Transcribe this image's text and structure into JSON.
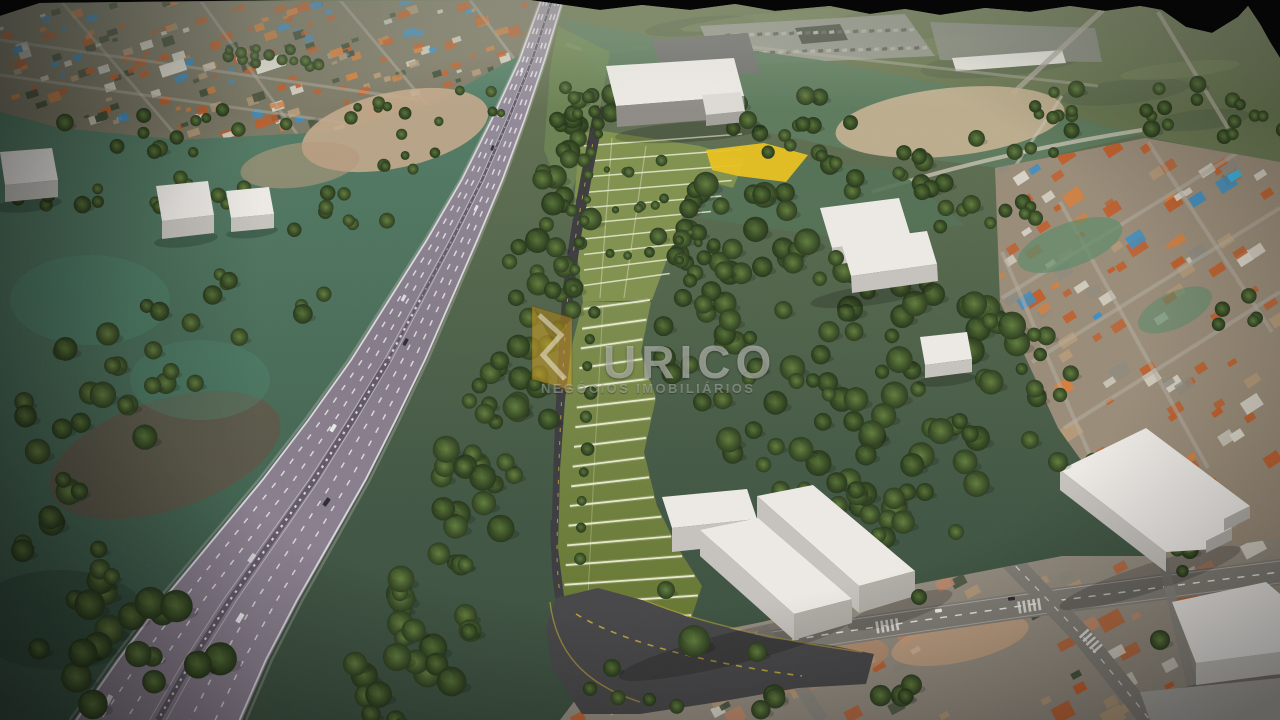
{
  "watermark": {
    "brand": "URICO",
    "tagline": "NEGÓCIOS IMOBILIÁRIOS"
  },
  "palette": {
    "sky": "#060606",
    "base_top": "#6d7657",
    "base_mid": "#55684d",
    "base_bot": "#415744",
    "far_field": "#6a7852",
    "urban_base": "#7d7a67",
    "city_right_base": "#9a8c79",
    "city_bottom_base": "#948c80",
    "roof_orange": "#c05f2c",
    "roof_orange2": "#d4803f",
    "roof_white": "#d9d5c9",
    "roof_dark": "#44503a",
    "roof_blue": "#3e8fc4",
    "roof_tan": "#b59a78",
    "roof_gray": "#8f8b80",
    "roof_salmon": "#c08a6a",
    "street_light": "#b3ada0",
    "asphalt_city": "#827e77",
    "teal_top": "#567f68",
    "teal_bot": "#3a5747",
    "dirt": "#c3a98b",
    "dirt_warm": "#c7b294",
    "salmon": "#c08a6a",
    "redbrown": "#6e4c42",
    "highway_top": "#9a93a1",
    "highway_mid": "#857b89",
    "highway_bot": "#8d8292",
    "median": "#5e5564",
    "lane_white": "#efedf1",
    "lawn_upper": "#81924f",
    "lot_top": "#7c8d4e",
    "lot_bot": "#64742f",
    "lot_line": "#eff1d8",
    "lot_yellow": "#e9c121",
    "road_dark": "#3d3d41",
    "road_access": "#474749",
    "road_yellow": "#d7b83c",
    "tree_hi": "#617e3e",
    "tree_mid": "#44592c",
    "tree_dark": "#2c3e20",
    "tree_hi2": "#546f36",
    "tree_mid2": "#3b5026",
    "tree_dark2": "#26371c",
    "bldg_roof": "#edeae6",
    "bldg_side": "#c6c3be",
    "bldg_end": "#b2afa9",
    "bldg_face": "#8f8c87",
    "pool_blue": "#3fb0d8",
    "wm_text": "rgba(216,218,214,0.55)",
    "wm_text_dim": "rgba(205,207,203,0.42)",
    "wm_gold": "rgba(203,158,40,0.58)"
  }
}
